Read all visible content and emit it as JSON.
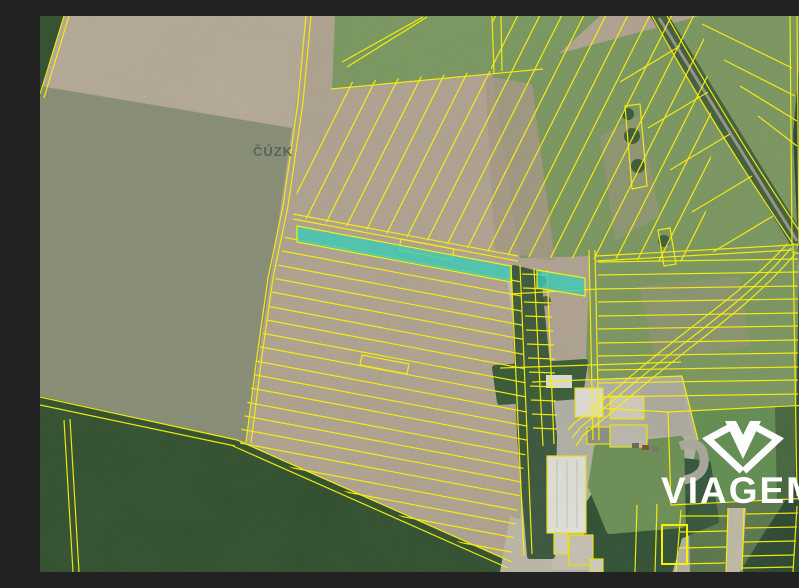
{
  "map": {
    "provider_watermark": "ČÚZK",
    "brand_watermark": {
      "label": "VIAGEM",
      "icon": "viagem-gem-icon"
    },
    "highlighted_parcel_count": 2,
    "colors": {
      "parcel_line": "#f8ee0e",
      "highlight": "#3cc9b6",
      "watermark": "#4f5950",
      "brand": "#ffffff",
      "field_tan": "#b7a996",
      "field_sage": "#8d9379",
      "field_green": "#7f9c63",
      "forest_dark": "#2f5134",
      "farm_concrete": "#b9b7ac"
    }
  }
}
